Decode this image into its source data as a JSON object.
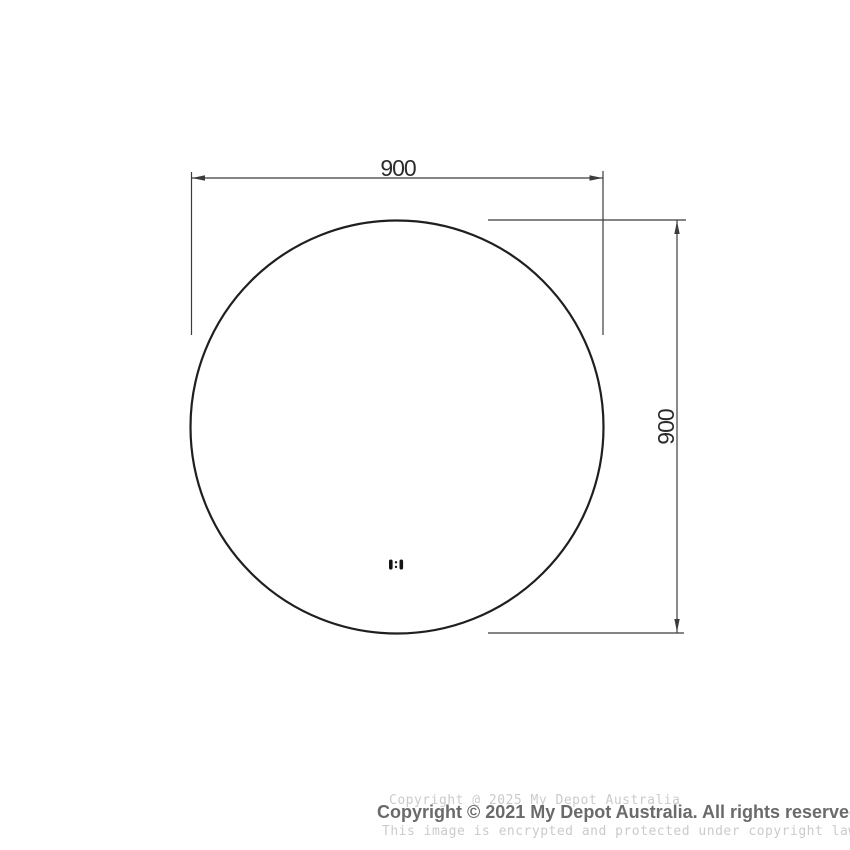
{
  "drawing": {
    "type": "technical-dimension-diagram",
    "shape": "circle",
    "width_dimension_label": "900",
    "height_dimension_label": "900",
    "icons": {
      "touch_sensor": "touch-sensor-icon"
    },
    "colors": {
      "outline": "#1f1f1f",
      "dimension_lines": "#3c3c3c",
      "dimension_text": "#2b2b2b"
    }
  },
  "footer": {
    "watermark_top": "Copyright @ 2025 My Depot Australia",
    "copyright": "Copyright © 2021 My Depot Australia. All rights reserved.",
    "watermark_bottom": "This image is encrypted and protected under copyright law.",
    "colors": {
      "watermark": "#cbcbcb",
      "copyright_text": "#6a6a6a"
    }
  }
}
